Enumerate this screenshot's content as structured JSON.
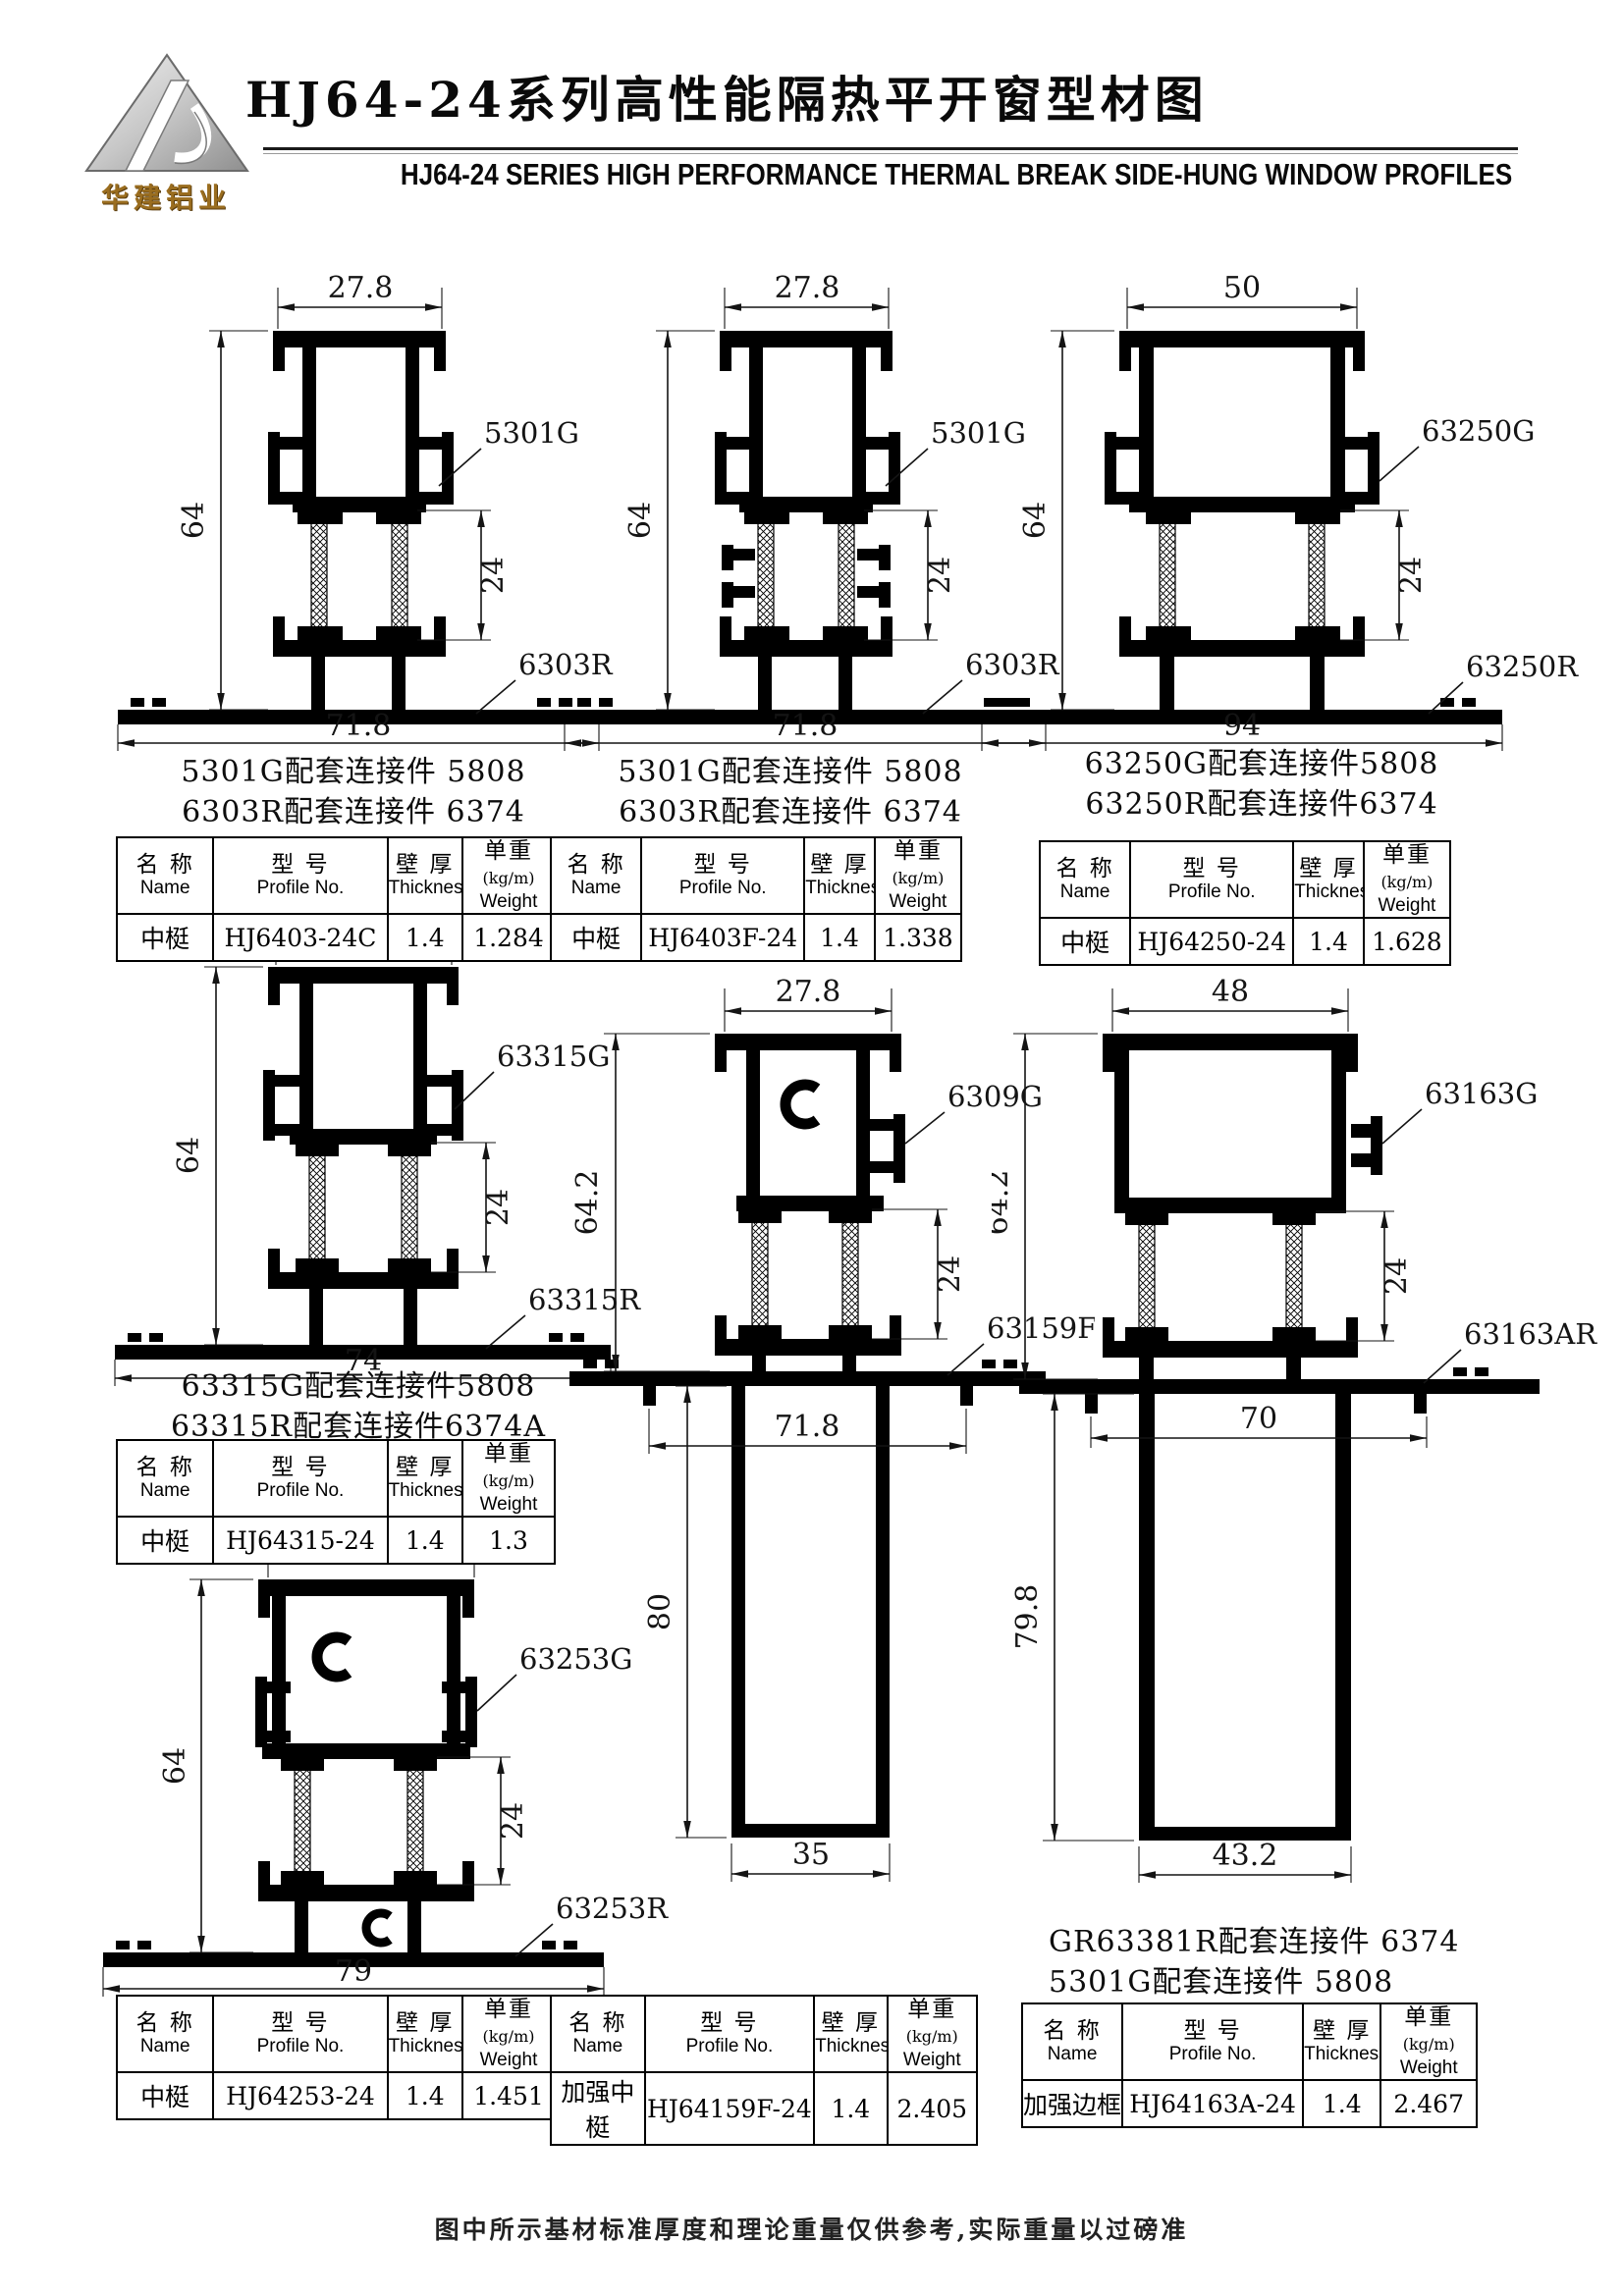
{
  "header": {
    "logo_text": "华建铝业",
    "title_cn": "HJ64-24系列高性能隔热平开窗型材图",
    "title_en": "HJ64-24  SERIES  HIGH PERFORMANCE THERMAL BREAK SIDE-HUNG  WINDOW  PROFILES"
  },
  "table_header": {
    "name_cn": "名 称",
    "name_en": "Name",
    "model_cn": "型 号",
    "model_en": "Profile No.",
    "thick_cn": "壁 厚",
    "thick_en": "Thickness",
    "weight_cn": "单重",
    "weight_paren": "(kg/m)",
    "weight_en": "Weight"
  },
  "drawings": {
    "d1": {
      "dim_top": "27.8",
      "dim_height": "64",
      "dim_break": "24",
      "dim_bottom": "71.8",
      "label_g": "5301G",
      "label_r": "6303R"
    },
    "d2": {
      "dim_top": "27.8",
      "dim_height": "64",
      "dim_break": "24",
      "dim_bottom": "71.8",
      "label_g": "5301G",
      "label_r": "6303R"
    },
    "d3": {
      "dim_top": "50",
      "dim_height": "64",
      "dim_break": "24",
      "dim_bottom": "94",
      "label_g": "63250G",
      "label_r": "63250R"
    },
    "d4": {
      "dim_top": "30",
      "dim_height": "64",
      "dim_break": "24",
      "dim_bottom": "74",
      "label_g": "63315G",
      "label_r": "63315R"
    },
    "d5": {
      "dim_top": "27.8",
      "dim_height": "64.2",
      "dim_break": "24",
      "dim_flange": "71.8",
      "dim_box_h": "80",
      "dim_box_w": "35",
      "label_g": "6309G",
      "label_r": "63159F"
    },
    "d6": {
      "dim_top": "48",
      "dim_height": "64.2",
      "dim_break": "24",
      "dim_flange": "70",
      "dim_box_h": "79.8",
      "dim_box_w": "43.2",
      "label_g": "63163G",
      "label_r": "63163AR"
    },
    "d7": {
      "dim_top": "35",
      "dim_height": "64",
      "dim_break": "24",
      "dim_bottom": "79",
      "label_g": "63253G",
      "label_r": "63253R"
    }
  },
  "notes": {
    "n1": [
      "5301G配套连接件 5808",
      "6303R配套连接件 6374"
    ],
    "n2": [
      "5301G配套连接件 5808",
      "6303R配套连接件 6374"
    ],
    "n3": [
      "63250G配套连接件5808",
      "63250R配套连接件6374"
    ],
    "n4": [
      "63315G配套连接件5808",
      "63315R配套连接件6374A"
    ],
    "n7": [
      "GR63381R配套连接件 6374",
      "5301G配套连接件 5808"
    ]
  },
  "tables": {
    "t1": {
      "name": "中梃",
      "model": "HJ6403-24C",
      "thickness": "1.4",
      "weight": "1.284"
    },
    "t2": {
      "name": "中梃",
      "model": "HJ6403F-24",
      "thickness": "1.4",
      "weight": "1.338"
    },
    "t3": {
      "name": "中梃",
      "model": "HJ64250-24",
      "thickness": "1.4",
      "weight": "1.628"
    },
    "t4": {
      "name": "中梃",
      "model": "HJ64315-24",
      "thickness": "1.4",
      "weight": "1.3"
    },
    "t5": {
      "name": "中梃",
      "model": "HJ64253-24",
      "thickness": "1.4",
      "weight": "1.451"
    },
    "t6": {
      "name": "加强中梃",
      "model": "HJ64159F-24",
      "thickness": "1.4",
      "weight": "2.405"
    },
    "t7": {
      "name": "加强边框",
      "model": "HJ64163A-24",
      "thickness": "1.4",
      "weight": "2.467"
    }
  },
  "footer": "图中所示基材标准厚度和理论重量仅供参考,实际重量以过磅准"
}
